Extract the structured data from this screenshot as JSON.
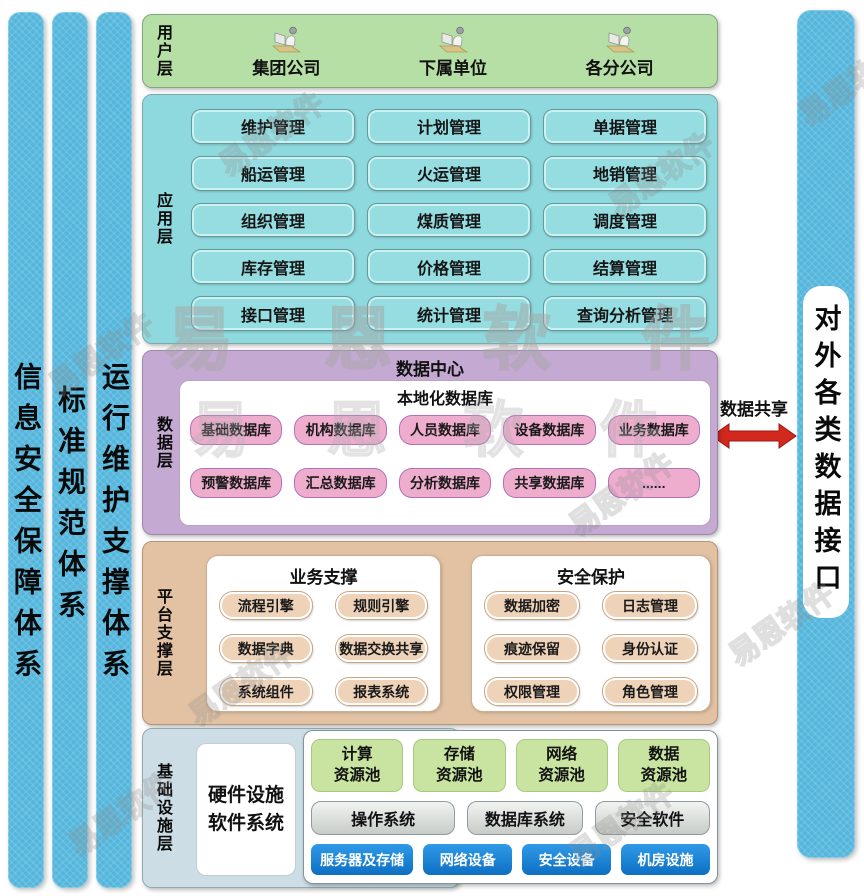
{
  "left_bars": [
    {
      "label": "信息安全保障体系"
    },
    {
      "label": "标准规范体系"
    },
    {
      "label": "运行维护支撑体系"
    }
  ],
  "right_bar": {
    "label": "对外各类数据接口"
  },
  "data_share": {
    "label": "数据共享"
  },
  "user_layer": {
    "label": "用户层",
    "items": [
      "集团公司",
      "下属单位",
      "各分公司"
    ]
  },
  "app_layer": {
    "label": "应用层",
    "modules": [
      "维护管理",
      "计划管理",
      "单据管理",
      "船运管理",
      "火运管理",
      "地销管理",
      "组织管理",
      "煤质管理",
      "调度管理",
      "库存管理",
      "价格管理",
      "结算管理",
      "接口管理",
      "统计管理",
      "查询分析管理"
    ]
  },
  "data_layer": {
    "label": "数据层",
    "center_title": "数据中心",
    "local_db_title": "本地化数据库",
    "row1": [
      "基础数据库",
      "机构数据库",
      "人员数据库",
      "设备数据库",
      "业务数据库"
    ],
    "row2": [
      "预警数据库",
      "汇总数据库",
      "分析数据库",
      "共享数据库",
      "......"
    ]
  },
  "platform_layer": {
    "label": "平台支撑层",
    "business": {
      "title": "业务支撑",
      "items": [
        "流程引擎",
        "规则引擎",
        "数据字典",
        "数据交换共享",
        "系统组件",
        "报表系统"
      ]
    },
    "security": {
      "title": "安全保护",
      "items": [
        "数据加密",
        "日志管理",
        "痕迹保留",
        "身份认证",
        "权限管理",
        "角色管理"
      ]
    }
  },
  "infra_layer": {
    "label": "基础设施层",
    "hw_sw_line1": "硬件设施",
    "hw_sw_line2": "软件系统",
    "pools": [
      {
        "l1": "计算",
        "l2": "资源池"
      },
      {
        "l1": "存储",
        "l2": "资源池"
      },
      {
        "l1": "网络",
        "l2": "资源池"
      },
      {
        "l1": "数据",
        "l2": "资源池"
      }
    ],
    "software": [
      "操作系统",
      "数据库系统",
      "安全软件"
    ],
    "hardware": [
      "服务器及存储",
      "网络设备",
      "安全设备",
      "机房设施"
    ]
  },
  "watermark": {
    "large": "易 恩 软 件",
    "small": "易恩软件"
  },
  "colors": {
    "side_bar_blue": "#54b6dc",
    "user_green": "#b6dfa6",
    "app_teal": "#8ed9dd",
    "data_purple": "#c4a9d2",
    "db_pill_pink": "#efadce",
    "platform_tan": "#e2c2a3",
    "platform_pill_tan": "#eed3b9",
    "infra_blue_gray": "#ccdde5",
    "pool_green": "#c9e4a1",
    "hardware_blue": "#1581d6",
    "arrow_red": "#d3281e"
  }
}
